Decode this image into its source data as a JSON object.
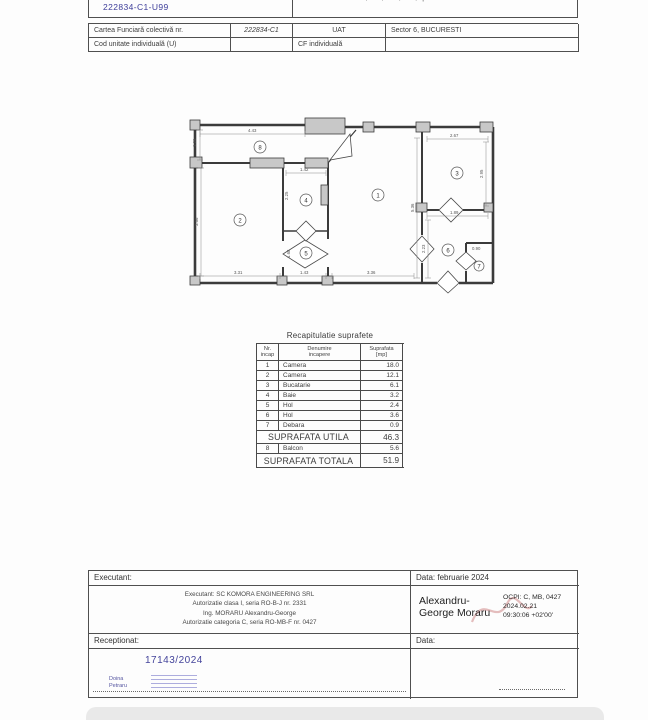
{
  "header": {
    "unit_id": "222834-C1-U99",
    "address": "Bul. Uverturii nr. 51-55, bl. 2, sc. 2, et. 2, ap. 99",
    "row1": {
      "label": "Cartea Funciară colectivă nr.",
      "value": "222834-C1",
      "label2": "UAT",
      "value2": "Sector 6, BUCURESTI"
    },
    "row2": {
      "label": "Cod unitate individuală (U)",
      "value": "",
      "label2": "CF individuală",
      "value2": ""
    }
  },
  "plan": {
    "rooms": {
      "r1": "1",
      "r2": "2",
      "r3": "3",
      "r4": "4",
      "r5": "5",
      "r6": "6",
      "r7": "7",
      "r8": "8"
    },
    "dims": {
      "balcony_w": "4.43",
      "balcony_d": "1.26",
      "room4_w": "1.42",
      "room4_h": "2.25",
      "room3_w": "2.67",
      "room3_h": "2.95",
      "room1_h": "5.36",
      "room2_h": "3.66",
      "hall5_h": "1.68",
      "hall6_w": "1.89",
      "hall6_h": "2.23",
      "room7_w": "0.90",
      "bottom_room2": "3.31",
      "bottom_hall5": "1.43",
      "bottom_room1": "3.36"
    }
  },
  "recap": {
    "title": "Recapitulatie suprafete",
    "headers": {
      "nr1": "Nr.",
      "nr2": "incap",
      "name1": "Denumire",
      "name2": "incapere",
      "area1": "Suprafata",
      "area2": "[mp]"
    },
    "rows": [
      {
        "nr": "1",
        "name": "Camera",
        "area": "18.0"
      },
      {
        "nr": "2",
        "name": "Camera",
        "area": "12.1"
      },
      {
        "nr": "3",
        "name": "Bucatarie",
        "area": "6.1"
      },
      {
        "nr": "4",
        "name": "Baie",
        "area": "3.2"
      },
      {
        "nr": "5",
        "name": "Hol",
        "area": "2.4"
      },
      {
        "nr": "6",
        "name": "Hol",
        "area": "3.6"
      },
      {
        "nr": "7",
        "name": "Debara",
        "area": "0.9"
      }
    ],
    "utila_label": "SUPRAFATA UTILA",
    "utila_value": "46.3",
    "balcon_row": {
      "nr": "8",
      "name": "Balcon",
      "area": "5.6"
    },
    "totala_label": "SUPRAFATA TOTALA",
    "totala_value": "51.9"
  },
  "footer": {
    "executant_label": "Executant:",
    "executant_date": "Data: februarie 2024",
    "executant_lines": {
      "l1": "Executant: SC KOMORA ENGINEERING SRL",
      "l2": "Autorizatie clasa I, seria RO-B-J nr. 2331",
      "l3": "Ing. MORARU Alexandru-George",
      "l4": "Autorizatie categoria C, seria RO-MB-F nr. 0427"
    },
    "signer_line1": "Alexandru-",
    "signer_line2": "George Moraru",
    "sig_details": {
      "l1": "OCPI: C, MB, 0427",
      "l2": "2024.02.21",
      "l3": "09:30:06 +02'00'"
    },
    "receptionat_label": "Receptionat:",
    "receptionat_date": "Data:",
    "registration_number": "17143/2024",
    "stamp_name1": "Doina",
    "stamp_name2": "Petraru"
  },
  "colors": {
    "accent_blue": "#3d3d99",
    "signature_red": "#d08a8a",
    "wall_gray": "#c8c8c8"
  }
}
